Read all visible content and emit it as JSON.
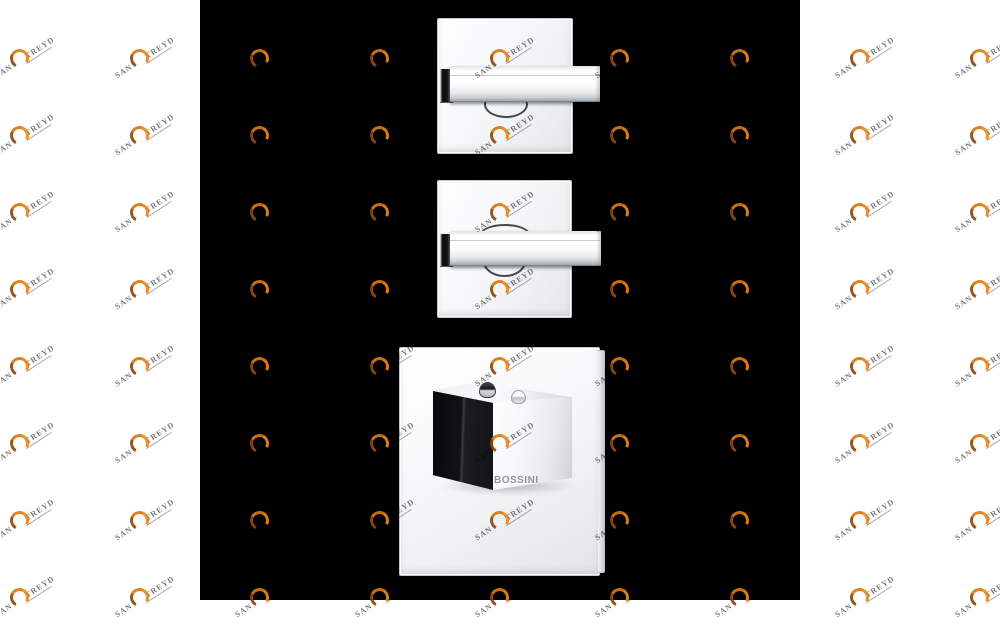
{
  "canvas": {
    "panel_color": "#000000",
    "margin_color": "#ffffff"
  },
  "watermark": {
    "brand_prefix": "SAN",
    "brand_suffix": "TREYD",
    "text_color": "#7b7b7b",
    "arc_color": "#d8790f",
    "arc_dark_color": "#8a4a12"
  },
  "products": {
    "bottom_mixer": {
      "brand_label": "BOSSINI"
    }
  }
}
